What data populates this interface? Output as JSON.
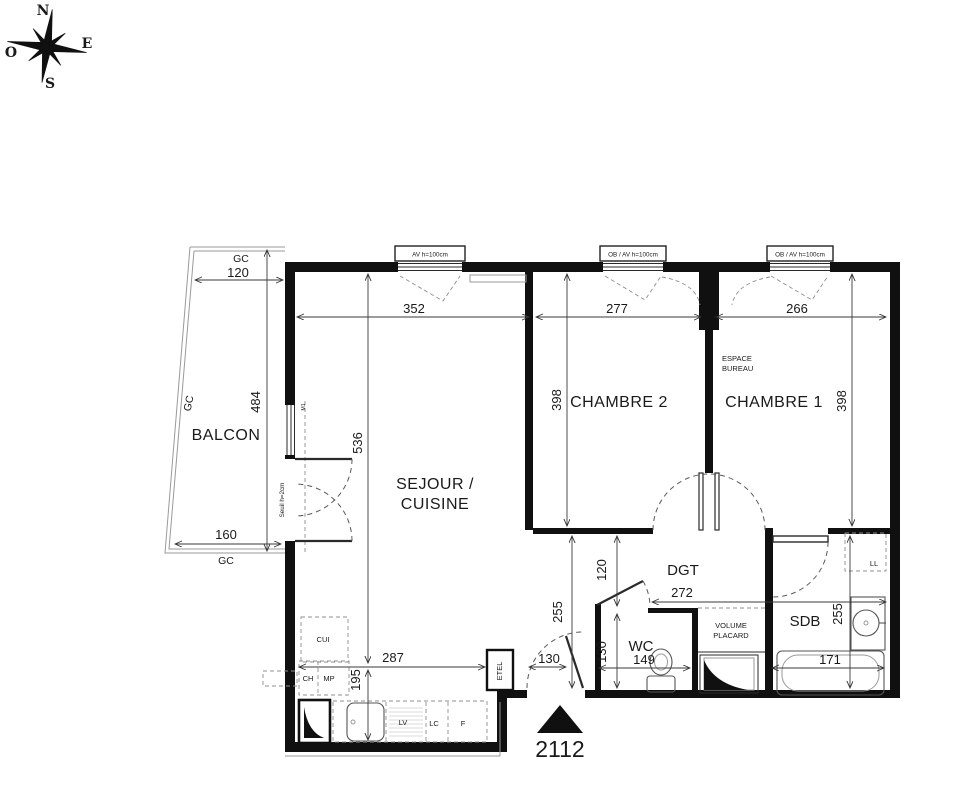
{
  "compass": {
    "n": "N",
    "e": "E",
    "s": "S",
    "o": "O"
  },
  "unit_number": "2112",
  "rooms": {
    "balcony": "BALCON",
    "living_line1": "SEJOUR /",
    "living_line2": "CUISINE",
    "bedroom2": "CHAMBRE 2",
    "bedroom1": "CHAMBRE 1",
    "office_line1": "ESPACE",
    "office_line2": "BUREAU",
    "hallway": "DGT",
    "wc": "WC",
    "bathroom": "SDB",
    "closet_line1": "VOLUME",
    "closet_line2": "PLACARD"
  },
  "fixtures": {
    "kitchen_unit": "CUI",
    "water_heater": "CH",
    "mp": "MP",
    "dishwasher": "LV",
    "laundry_column": "LC",
    "fridge": "F",
    "etel": "ETEL",
    "washing_machine": "LL"
  },
  "windows": {
    "av": "AV h=100cm",
    "ob_left": "OB / AV h=100cm",
    "ob_right": "OB / AV h=100cm",
    "threshold": "Seuil h=2cm",
    "tag_m1": "M1"
  },
  "dims": {
    "balcony_top_gc": "GC",
    "balcony_top": "120",
    "balcony_side_gc": "GC",
    "balcony_height": "484",
    "balcony_bottom": "160",
    "balcony_bottom_gc": "GC",
    "living_width": "352",
    "bedroom2_width": "277",
    "bedroom1_width": "266",
    "bedroom2_depth": "398",
    "bedroom1_depth": "398",
    "living_depth": "536",
    "kitchen_width": "287",
    "kitchen_depth": "195",
    "hall_width": "272",
    "hall_depth": "120",
    "hall_side": "255",
    "wc_width": "149",
    "wc_depth": "130",
    "entry_width": "130",
    "bath_depth": "255",
    "bath_width": "171"
  },
  "colors": {
    "line": "#1a1a1a",
    "wall": "#101010",
    "background": "#ffffff"
  }
}
